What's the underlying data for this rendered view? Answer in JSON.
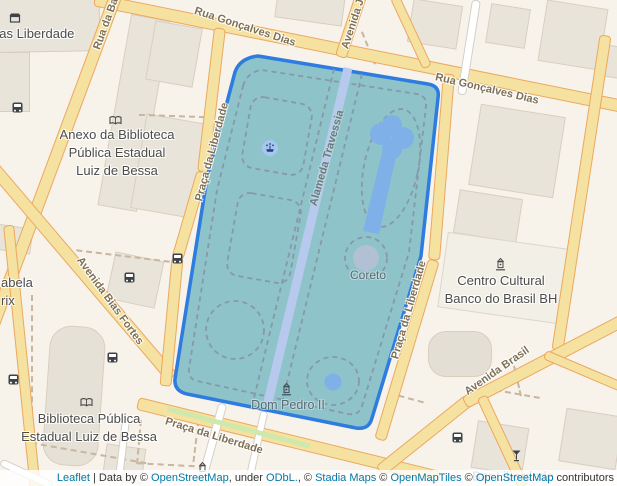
{
  "colors": {
    "land": "#f8f3ea",
    "building": "#e9e4da",
    "road_fill": "#f5e1a0",
    "road_casing": "#eba860",
    "minor_road": "#ffffff",
    "park_fill": "#8dc3c9",
    "park_outline": "#2e7ce0",
    "water": "#7fb1e8",
    "park_footpath": "#8898aa",
    "footpath": "#c7b6a0",
    "street_label": "#7e7054",
    "poi_label": "#4b4b4b",
    "park_label": "#5c6a74",
    "link": "#0078a8",
    "median_green": "#cfe8ab"
  },
  "street_labels": {
    "goncalves_dias_1": "Rua Gonçalves Dias",
    "goncalves_dias_2": "Rua Gonçalves Dias",
    "rua_da_bahia": "Rua da Ba",
    "avenida_joao": "Avenida J",
    "praca_liberdade_left": "Praça da Liberdade",
    "praca_liberdade_right": "Praça da Liberdade",
    "praca_liberdade_bottom": "Praça da Liberdade",
    "avenida_bias_fortes": "Avenida Bias Fortes",
    "avenida_brasil": "Avenida Brasil",
    "alameda_travessia": "Alameda Travessia"
  },
  "poi_labels": {
    "nas_liberdade": "nas Liberdade",
    "anexo_line1": "Anexo da Biblioteca",
    "anexo_line2": "Pública Estadual",
    "anexo_line3": "Luiz de Bessa",
    "abela": "abela",
    "rix": "rix",
    "biblioteca_line1": "Biblioteca Pública",
    "biblioteca_line2": "Estadual Luiz de Bessa",
    "ccbb_line1": "Centro Cultural",
    "ccbb_line2": "Banco do Brasil BH",
    "coreto": "Coreto",
    "dom_pedro": "Dom Pedro II",
    "bar_liberdade": "Bar Liberdade"
  },
  "icons": {
    "bus_stop": "bus-icon",
    "library": "open-book-icon",
    "fountain": "fountain-icon",
    "monument": "monument-icon",
    "shop": "shop-icon",
    "bar": "bar-glass-icon"
  },
  "attribution": {
    "parts": [
      {
        "text": "Leaflet",
        "link": true
      },
      {
        "text": " | Data by ",
        "link": false
      },
      {
        "text": "© ",
        "link": false
      },
      {
        "text": "OpenStreetMap",
        "link": true
      },
      {
        "text": ", under ",
        "link": false
      },
      {
        "text": "ODbL.",
        "link": true
      },
      {
        "text": ", © ",
        "link": false
      },
      {
        "text": "Stadia Maps",
        "link": true
      },
      {
        "text": " © ",
        "link": false
      },
      {
        "text": "OpenMapTiles",
        "link": true
      },
      {
        "text": " © ",
        "link": false
      },
      {
        "text": "OpenStreetMap",
        "link": true
      },
      {
        "text": " contributors",
        "link": false
      }
    ]
  }
}
